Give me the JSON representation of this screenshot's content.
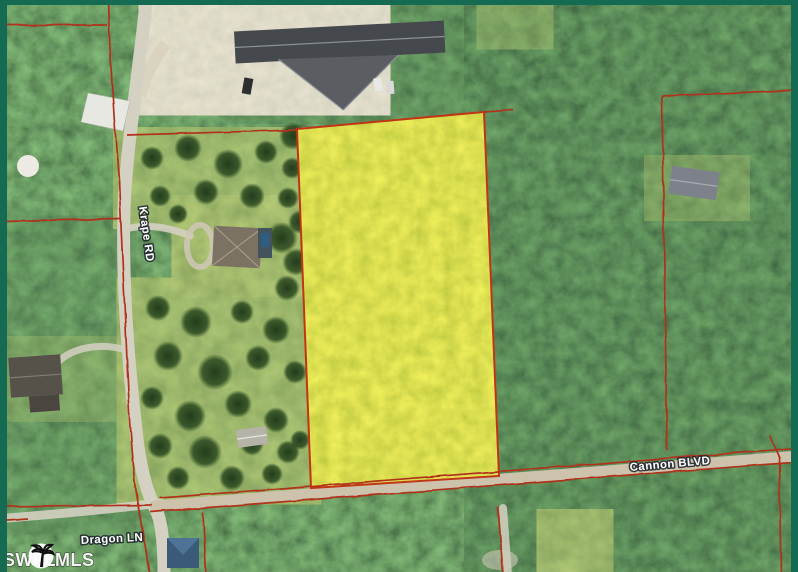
{
  "map": {
    "road_labels": {
      "krape": "Krape RD",
      "cannon": "Cannon BLVD",
      "dragon": "Dragon LN"
    },
    "watermark": {
      "left": "SWFL",
      "right": "MLS",
      "logo_icon": "palm-tree-icon"
    },
    "colors": {
      "parcel_fill": "#e6e332",
      "boundary": "#b0301a",
      "frame": "#156b52",
      "road": "#d4d0c2",
      "dirt_road": "#cdc3ac",
      "label_text": "#ffffff",
      "watermark_text": "#ffffff"
    }
  }
}
